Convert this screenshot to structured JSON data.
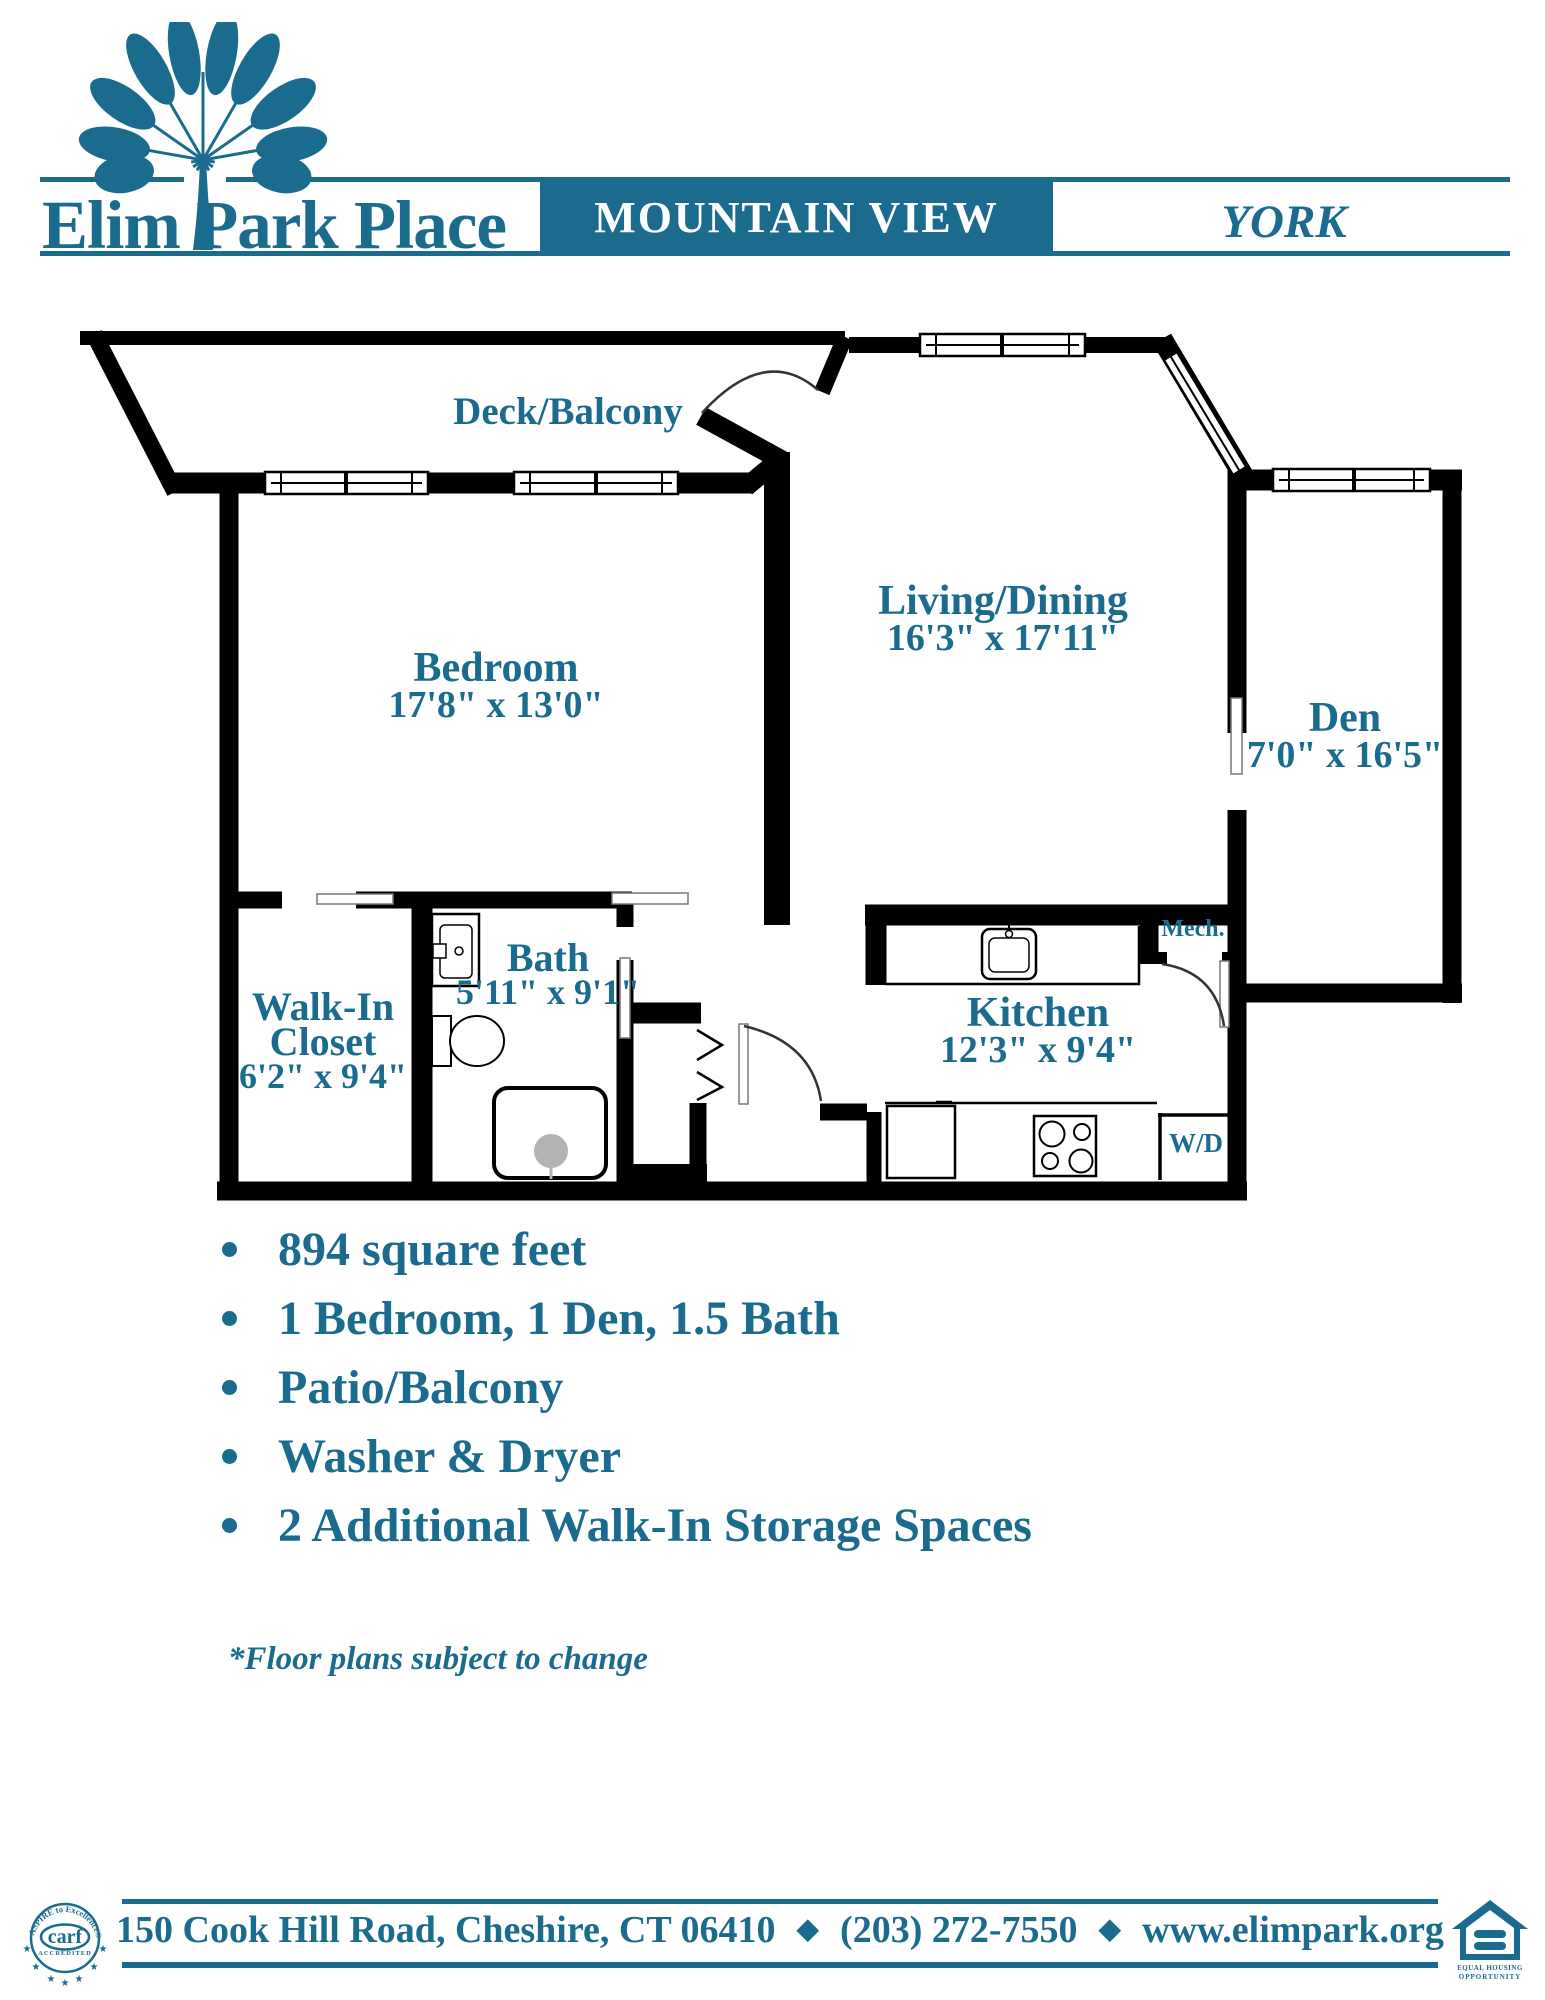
{
  "colors": {
    "teal": "#1a6b8e",
    "wall": "#000000"
  },
  "header": {
    "brand": "Elim Park Place",
    "community": "MOUNTAIN VIEW",
    "unit_name": "YORK"
  },
  "floor_plan": {
    "deck": {
      "name": "Deck/Balcony"
    },
    "bedroom": {
      "name": "Bedroom",
      "dims": "17'8\" x 13'0\""
    },
    "living": {
      "name": "Living/Dining",
      "dims": "16'3\" x 17'11\""
    },
    "den": {
      "name": "Den",
      "dims": "7'0\" x 16'5\""
    },
    "closet": {
      "line1": "Walk-In",
      "line2": "Closet",
      "dims": "6'2\" x 9'4\""
    },
    "bath": {
      "name": "Bath",
      "dims": "5'11\" x 9'1\""
    },
    "kitchen": {
      "name": "Kitchen",
      "dims": "12'3\" x 9'4\""
    },
    "mech": {
      "name": "Mech."
    },
    "washer_dryer": {
      "name": "W/D"
    }
  },
  "features": [
    "894 square feet",
    "1 Bedroom, 1 Den, 1.5 Bath",
    "Patio/Balcony",
    "Washer & Dryer",
    "2 Additional Walk-In Storage Spaces"
  ],
  "note": "*Floor plans subject to change",
  "footer": {
    "address": "150 Cook Hill Road, Cheshire, CT 06410",
    "phone": "(203) 272-7550",
    "website": "www.elimpark.org",
    "separator": "◆",
    "carf": {
      "arc_text": "ASPIRE to Excellence®",
      "word": "carf",
      "sub": "ACCREDITED"
    },
    "eho": {
      "line1": "EQUAL HOUSING",
      "line2": "OPPORTUNITY"
    }
  }
}
